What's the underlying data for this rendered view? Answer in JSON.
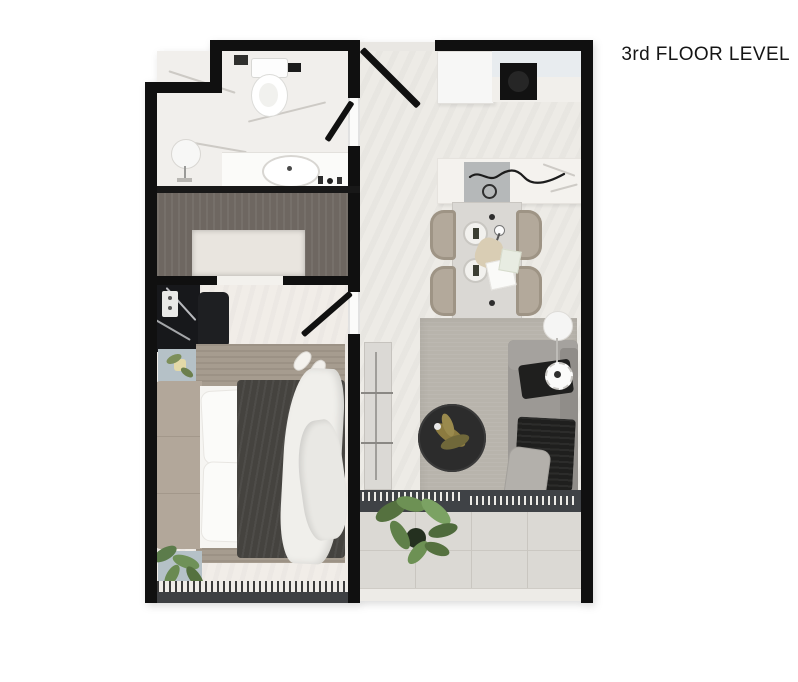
{
  "header": {
    "title": "3rd FLOOR LEVEL"
  },
  "figure": {
    "type": "apartment-floor-plan",
    "view": "top-down-render",
    "rooms": [
      {
        "name": "bathroom",
        "position": "top-left",
        "items": [
          "toilet",
          "wall-vent",
          "vanity-counter",
          "oval-basin",
          "faucet",
          "floor-lamp",
          "toiletry-bottles",
          "swing-door"
        ]
      },
      {
        "name": "entry-hall",
        "position": "top-center",
        "items": [
          "entry-door-swing",
          "threshold"
        ]
      },
      {
        "name": "kitchen",
        "position": "top-right",
        "items": [
          "white-cabinet",
          "glass-panel",
          "counter",
          "cooktop",
          "island",
          "island-mat",
          "decor-squiggle",
          "island-faucet"
        ]
      },
      {
        "name": "dining-area",
        "position": "right-middle",
        "items": [
          "dining-table",
          "chair",
          "chair",
          "chair",
          "chair",
          "plate",
          "plate",
          "wine-glass",
          "bread-decor",
          "napkins"
        ]
      },
      {
        "name": "living-room",
        "position": "right-lower",
        "items": [
          "area-rug",
          "tv-console",
          "round-coffee-table",
          "dried-plant-decor",
          "sofa",
          "black-throw",
          "black-blanket",
          "cushion",
          "floor-lamp-pendant"
        ]
      },
      {
        "name": "bedroom",
        "position": "left",
        "items": [
          "wardrobe",
          "closet-recess",
          "black-marble-desk",
          "light-switch",
          "desk-chair",
          "nightstand-top",
          "nightstand-bottom",
          "bed",
          "headboard",
          "pillows",
          "accent-pillow",
          "dark-duvet",
          "white-crumpled-blanket",
          "slippers",
          "bed-rug",
          "plant",
          "window-curtain",
          "swing-door"
        ]
      },
      {
        "name": "balcony",
        "position": "bottom-right",
        "items": [
          "sliding-door-threshold",
          "tiled-floor",
          "green-plant",
          "railing"
        ]
      }
    ]
  },
  "palette": {
    "wall": "#101010",
    "floor_main": "#edebe6",
    "floor_bedroom": "#f1ede8",
    "floor_bath": "#f1efec",
    "wardrobe": "#6e6761",
    "rug_bed": "#a69c8f",
    "rug_living": "#b8b4ac",
    "sofa": "#9c9995",
    "duvet": "#45433f",
    "nightstand": "#b5c1c7",
    "plant_green": "#6d9154",
    "balcony_tile": "#dbd9d4",
    "threshold": "#3f4246",
    "title_text": "#151515"
  }
}
